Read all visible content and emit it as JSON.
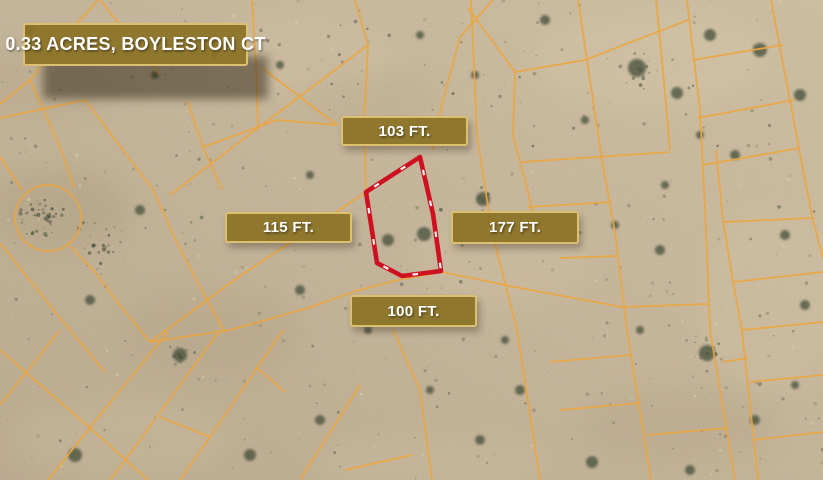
{
  "map": {
    "title_badge": {
      "label": "0.33 ACRES, BOYLESTON CT"
    },
    "dimension_labels": {
      "top": "103 FT.",
      "left": "115 FT.",
      "right": "177 FT.",
      "bottom": "100 FT."
    },
    "parcel": {
      "acres": "0.33",
      "street": "BOYLESTON CT",
      "outline_points": "420,157 366,192 377,263 402,276 441,271 433,214",
      "outline_color": "#ce1020",
      "tick_color": "#ffffff"
    },
    "colors": {
      "sand_base": "#c7b69b",
      "sand_light": "#d2c2a6",
      "sand_dark": "#bcab8f",
      "lot_line": "#eaa641",
      "badge_fill": "rgba(139,114,38,0.93)",
      "badge_border": "#dcc070",
      "badge_text": "#ffffff",
      "shrub": "#49523e"
    }
  }
}
